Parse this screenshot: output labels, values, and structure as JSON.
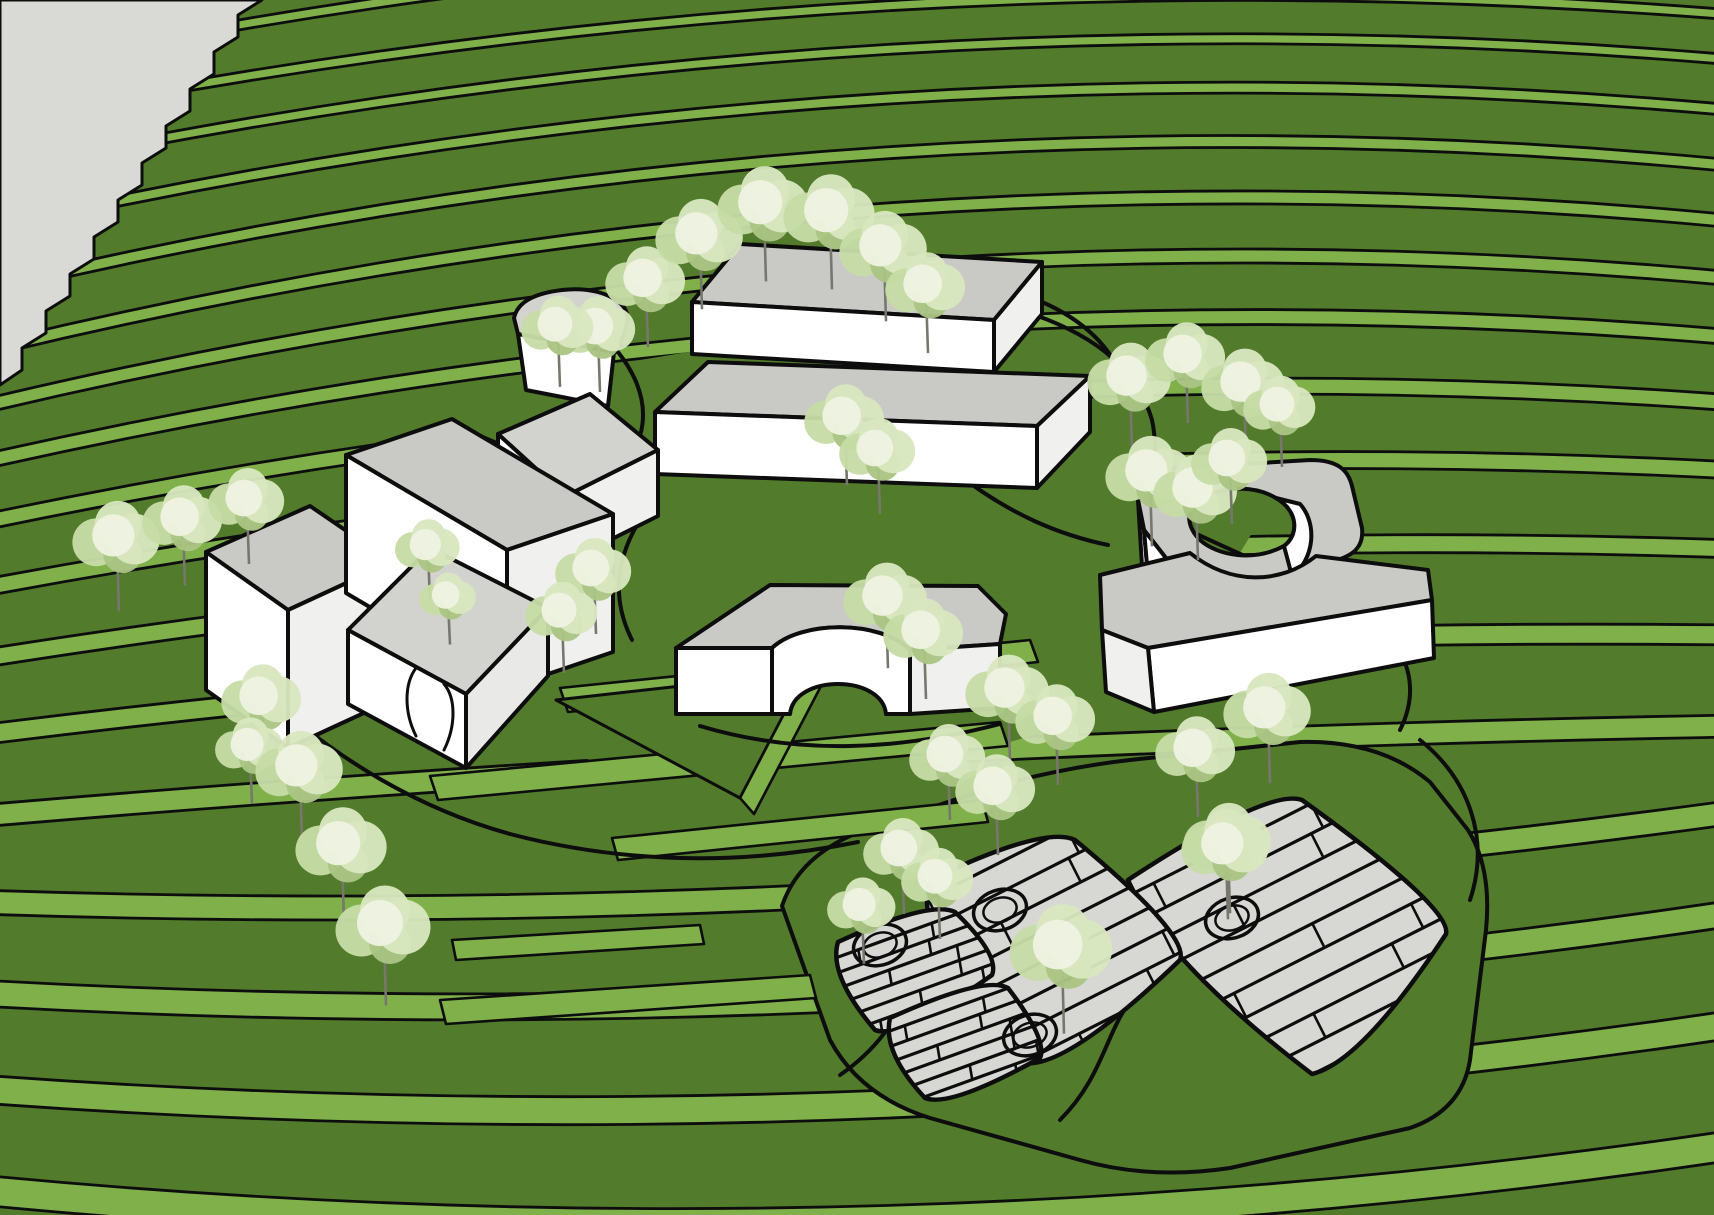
{
  "scene": {
    "description": "3D architectural site massing model on terraced green hillside",
    "width": 1714,
    "height": 1215,
    "apex_x": 860
  },
  "colors": {
    "grass_dark": "#527b2c",
    "grass_riser": "#7fb04a",
    "outline": "#0d0d0d",
    "model_edge_gray": "#d9d9d5",
    "roof": "#c9cac6",
    "roof_light": "#d2d3cf",
    "wall_white": "#ffffff",
    "wall_shade": "#f0f0ee",
    "wall_shade2": "#e9e9e7",
    "paving": "#d7d7d4",
    "trunk": "#77776e",
    "canopy_hi": "#eef3e1",
    "canopy_mid": "#d8e7c0",
    "canopy_base": "#c6dca6",
    "canopy_dark": "#abc584"
  },
  "terrain": {
    "bands": [
      [
        70,
        -120,
        -40,
        10
      ],
      [
        120,
        -60,
        10,
        10
      ],
      [
        170,
        -20,
        55,
        10
      ],
      [
        225,
        25,
        105,
        11
      ],
      [
        285,
        75,
        160,
        12
      ],
      [
        345,
        130,
        215,
        13
      ],
      [
        400,
        190,
        272,
        14
      ],
      [
        455,
        255,
        330,
        15
      ],
      [
        515,
        330,
        395,
        16
      ],
      [
        580,
        415,
        462,
        17
      ],
      [
        650,
        510,
        540,
        18
      ],
      [
        725,
        615,
        625,
        20
      ],
      [
        805,
        730,
        715,
        22
      ],
      [
        890,
        920,
        800,
        24
      ],
      [
        980,
        1030,
        900,
        26
      ],
      [
        1075,
        1140,
        1010,
        28
      ],
      [
        1175,
        1260,
        1130,
        30
      ]
    ],
    "gray_wedge": "M 0,0 L 262,0 L 238,15 L 238,37 L 214,52 L 214,74 L 190,89 L 190,111 L 166,126 L 166,148 L 142,163 L 142,185 L 118,200 L 118,222 L 94,237 L 94,259 L 70,274 L 70,296 L 46,311 L 46,333 L 22,348 L 22,370 L 0,385 Z",
    "plateau": "M 360,470 L 520,380 L 700,350 L 900,360 L 1100,420 L 1260,520 L 1150,700 L 950,760 L 700,800 L 480,720 L 380,580 Z",
    "walk_bands": [
      "M 560,688 L 1030,640 L 1038,662 L 568,712 Z",
      "M 430,776 L 1000,722 L 1008,746 L 438,800 Z",
      "M 612,838 L 982,800 L 988,822 L 618,860 Z",
      "M 440,1000 L 810,975 L 816,998 L 446,1024 Z",
      "M 452,940 L 700,925 L 704,944 L 456,960 Z"
    ],
    "triangle_plateau": "M 556,700 L 806,672 L 740,798 Z",
    "triangle_edge": "M 740,798 L 806,672 L 820,688 L 754,814 Z",
    "site_paths": [
      "M 1035,315 C 1100,338 1138,372 1152,420 C 1158,448 1155,475 1140,505",
      "M 1140,505 C 1210,545 1300,575 1370,620 C 1410,648 1420,690 1400,730",
      "M 955,472 C 1010,515 1060,535 1108,545",
      "M 640,520 C 615,560 612,600 632,640",
      "M 700,726 C 800,756 900,750 1000,724",
      "M 300,724 C 360,772 430,812 510,834",
      "M 510,834 C 640,868 760,862 858,842",
      "M 480,436 C 525,455 565,472 612,482",
      "M 1042,302 C 1088,322 1116,352 1128,392",
      "M 1420,740 C 1470,780 1490,840 1470,900",
      "M 618,352 C 640,380 648,408 640,436"
    ]
  },
  "plaza": {
    "base": "M 782,906 Q 800,852 870,828 L 990,788 Q 1060,768 1130,760 L 1300,742 Q 1380,740 1430,782 L 1468,830 Q 1492,868 1486,930 L 1470,1060 Q 1462,1110 1410,1128 L 1230,1168 Q 1150,1180 1080,1160 L 930,1118 Q 860,1096 830,1040 Z",
    "inner_paths": [
      "M 840,1075 C 920,1020 900,960 980,915",
      "M 1060,1120 C 1120,1060 1100,1000 1180,960"
    ],
    "pads": [
      {
        "name": "pad-large",
        "d": "M 1128,880 Q 1268,788 1302,800 Q 1452,908 1446,934 Q 1362,1062 1312,1074 Q 1165,962 1128,880 Z",
        "planks": {
          "x0": 1140,
          "y0": 890,
          "ux": 0.89,
          "uy": -0.45,
          "len": 340,
          "sx": 0.45,
          "sy": 0.89,
          "spacing": 27,
          "count": 10
        }
      },
      {
        "name": "pad-middle",
        "d": "M 930,880 Q 1045,825 1075,840 Q 1190,935 1180,960 Q 1060,1075 1020,1062 Q 910,940 930,880 Z",
        "planks": {
          "x0": 916,
          "y0": 905,
          "ux": 0.89,
          "uy": -0.45,
          "len": 300,
          "sx": 0.45,
          "sy": 0.89,
          "spacing": 27,
          "count": 8
        }
      },
      {
        "name": "pad-stairs-upper",
        "d": "M 838,942 Q 930,900 955,912 Q 1000,955 992,975 Q 900,1040 875,1030 Q 828,975 838,942 Z",
        "planks": {
          "x0": 852,
          "y0": 952,
          "ux": 0.94,
          "uy": -0.34,
          "len": 150,
          "sx": 0.17,
          "sy": 0.985,
          "spacing": 15,
          "count": 7
        }
      },
      {
        "name": "pad-stairs-lower",
        "d": "M 890,1018 Q 985,975 1008,988 Q 1048,1040 1040,1058 Q 950,1108 925,1098 Q 882,1052 890,1018 Z",
        "planks": {
          "x0": 898,
          "y0": 1028,
          "ux": 0.94,
          "uy": -0.34,
          "len": 160,
          "sx": 0.17,
          "sy": 0.985,
          "spacing": 15,
          "count": 7
        }
      }
    ],
    "rings": [
      {
        "cx": 1232,
        "cy": 918
      },
      {
        "cx": 1000,
        "cy": 910
      },
      {
        "cx": 1030,
        "cy": 1035
      },
      {
        "cx": 880,
        "cy": 945
      }
    ]
  },
  "buildings": [
    {
      "name": "building-upper-box",
      "parts": [
        {
          "d": "M 692,302 L 740,244 L 1042,262 L 994,320 Z",
          "f": "roof"
        },
        {
          "d": "M 692,302 L 994,320 L 994,372 L 692,354 Z",
          "f": "wall_white"
        },
        {
          "d": "M 994,320 L 1042,262 L 1042,314 L 994,372 Z",
          "f": "wall_shade"
        }
      ]
    },
    {
      "name": "building-tree-notch",
      "parts": [
        {
          "d": "M 514,318 C 518,300 538,293 562,290 C 588,287 610,293 622,305 C 630,313 628,324 624,334 L 616,352 L 560,358 C 540,360 526,352 520,342 Z",
          "f": "roof_light"
        },
        {
          "d": "M 518,334 L 614,352 L 608,406 L 526,390 Z",
          "f": "wall_white"
        }
      ]
    },
    {
      "name": "building-middle-box",
      "parts": [
        {
          "d": "M 655,412 L 708,362 L 1090,376 L 1037,426 Z",
          "f": "roof"
        },
        {
          "d": "M 655,412 L 1037,426 L 1037,488 L 655,474 Z",
          "f": "wall_white"
        },
        {
          "d": "M 1037,426 L 1090,376 L 1090,432 L 1037,488 Z",
          "f": "wall_shade"
        }
      ]
    },
    {
      "name": "building-small-wedge",
      "parts": [
        {
          "d": "M 498,434 L 590,394 L 658,450 L 566,496 Z",
          "f": "roof_light"
        },
        {
          "d": "M 498,434 L 566,496 L 566,562 L 498,500 Z",
          "f": "wall_white"
        },
        {
          "d": "M 566,496 L 658,450 L 658,516 L 566,562 Z",
          "f": "wall_shade"
        }
      ]
    },
    {
      "name": "building-left-box",
      "parts": [
        {
          "d": "M 206,552 L 310,506 L 392,562 L 288,610 Z",
          "f": "roof"
        },
        {
          "d": "M 206,552 L 288,610 L 288,748 L 206,690 Z",
          "f": "wall_white"
        },
        {
          "d": "M 288,610 L 392,562 L 392,700 L 288,748 Z",
          "f": "wall_shade"
        }
      ]
    },
    {
      "name": "building-tall-main",
      "parts": [
        {
          "d": "M 346,455 L 452,419 L 613,514 L 507,550 Z",
          "f": "roof"
        },
        {
          "d": "M 346,455 L 507,550 L 507,688 L 346,593 Z",
          "f": "wall_white"
        },
        {
          "d": "M 507,550 L 613,514 L 613,652 L 507,688 Z",
          "f": "wall_shade"
        }
      ]
    },
    {
      "name": "building-annex-serpentine",
      "parts": [
        {
          "d": "M 348,630 L 430,548 L 548,608 L 466,694 Z",
          "f": "roof_light"
        },
        {
          "d": "M 348,630 L 466,694 L 466,768 L 348,704 Z",
          "f": "wall_white"
        },
        {
          "d": "M 466,694 L 548,608 L 548,676 L 466,768 Z",
          "f": "wall_shade2"
        }
      ],
      "lines": [
        "M 416,668 C 404,684 404,712 416,736",
        "M 444,684 C 456,698 456,726 444,750"
      ]
    },
    {
      "name": "building-courtyard-ring",
      "parts": [
        {
          "d": "M 1138,500 C 1140,478 1156,470 1176,468 L 1310,460 C 1338,460 1348,470 1352,486 L 1362,528 C 1364,548 1352,556 1334,561 L 1248,582 C 1212,590 1184,580 1166,558 L 1144,530 Z M 1194,504 C 1216,486 1252,484 1276,498 C 1300,512 1298,536 1284,546 C 1254,562 1218,556 1200,540 C 1188,528 1186,514 1194,504 Z",
          "f": "roof",
          "evenodd": true
        },
        {
          "d": "M 1276,498 C 1300,512 1298,536 1284,546 L 1292,576 C 1314,560 1318,524 1300,504 Z",
          "f": "wall_white"
        },
        {
          "d": "M 1138,500 L 1144,530 L 1150,598 L 1142,566 Z",
          "f": "wall_white"
        },
        {
          "d": "M 1144,530 L 1166,558 C 1184,580 1212,590 1248,582 L 1250,640 C 1206,646 1172,632 1150,600 Z",
          "f": "wall_white"
        }
      ]
    },
    {
      "name": "building-long-wedge",
      "parts": [
        {
          "d": "M 1100,575 L 1190,553 C 1230,585 1280,585 1316,556 L 1428,570 L 1432,600 L 1148,648 L 1102,630 Z",
          "f": "roof"
        },
        {
          "d": "M 1148,648 L 1432,600 L 1434,658 L 1154,712 Z",
          "f": "wall_white"
        },
        {
          "d": "M 1102,630 L 1148,648 L 1154,712 L 1106,692 Z",
          "f": "wall_shade"
        }
      ]
    },
    {
      "name": "building-arch-pavilion",
      "parts": [
        {
          "d": "M 676,648 L 770,585 L 978,586 L 1006,614 L 1000,644 L 910,650 C 880,620 802,620 772,648 Z",
          "f": "roof"
        },
        {
          "d": "M 676,648 L 772,648 L 772,714 L 676,714 Z",
          "f": "wall_white"
        },
        {
          "d": "M 772,648 C 802,620 880,620 910,650 L 910,714 L 886,714 C 882,674 794,674 790,714 L 772,714 Z",
          "f": "wall_white"
        },
        {
          "d": "M 910,650 L 1000,644 L 1000,708 L 910,714 Z",
          "f": "wall_shade"
        }
      ]
    }
  ],
  "trees": [
    [
      117,
      540,
      46
    ],
    [
      183,
      521,
      42
    ],
    [
      247,
      502,
      40
    ],
    [
      428,
      548,
      34
    ],
    [
      448,
      598,
      30
    ],
    [
      262,
      700,
      42
    ],
    [
      250,
      748,
      36
    ],
    [
      300,
      770,
      46
    ],
    [
      342,
      848,
      48
    ],
    [
      384,
      928,
      50
    ],
    [
      598,
      330,
      40
    ],
    [
      646,
      282,
      42
    ],
    [
      700,
      238,
      46
    ],
    [
      764,
      207,
      48
    ],
    [
      830,
      215,
      48
    ],
    [
      884,
      250,
      46
    ],
    [
      926,
      288,
      42
    ],
    [
      558,
      328,
      38
    ],
    [
      845,
      420,
      42
    ],
    [
      878,
      452,
      40
    ],
    [
      594,
      572,
      40
    ],
    [
      562,
      614,
      38
    ],
    [
      886,
      600,
      44
    ],
    [
      924,
      634,
      42
    ],
    [
      1130,
      380,
      44
    ],
    [
      1186,
      358,
      42
    ],
    [
      1244,
      386,
      44
    ],
    [
      1280,
      408,
      38
    ],
    [
      1150,
      475,
      46
    ],
    [
      1196,
      492,
      44
    ],
    [
      1230,
      462,
      40
    ],
    [
      1268,
      712,
      46
    ],
    [
      1196,
      752,
      42
    ],
    [
      1228,
      842,
      46
    ],
    [
      1008,
      692,
      44
    ],
    [
      1056,
      720,
      42
    ],
    [
      948,
      758,
      40
    ],
    [
      996,
      790,
      42
    ],
    [
      902,
      852,
      40
    ],
    [
      938,
      880,
      38
    ],
    [
      862,
      908,
      36
    ],
    [
      1226,
      848,
      46
    ],
    [
      1062,
      950,
      54
    ]
  ]
}
